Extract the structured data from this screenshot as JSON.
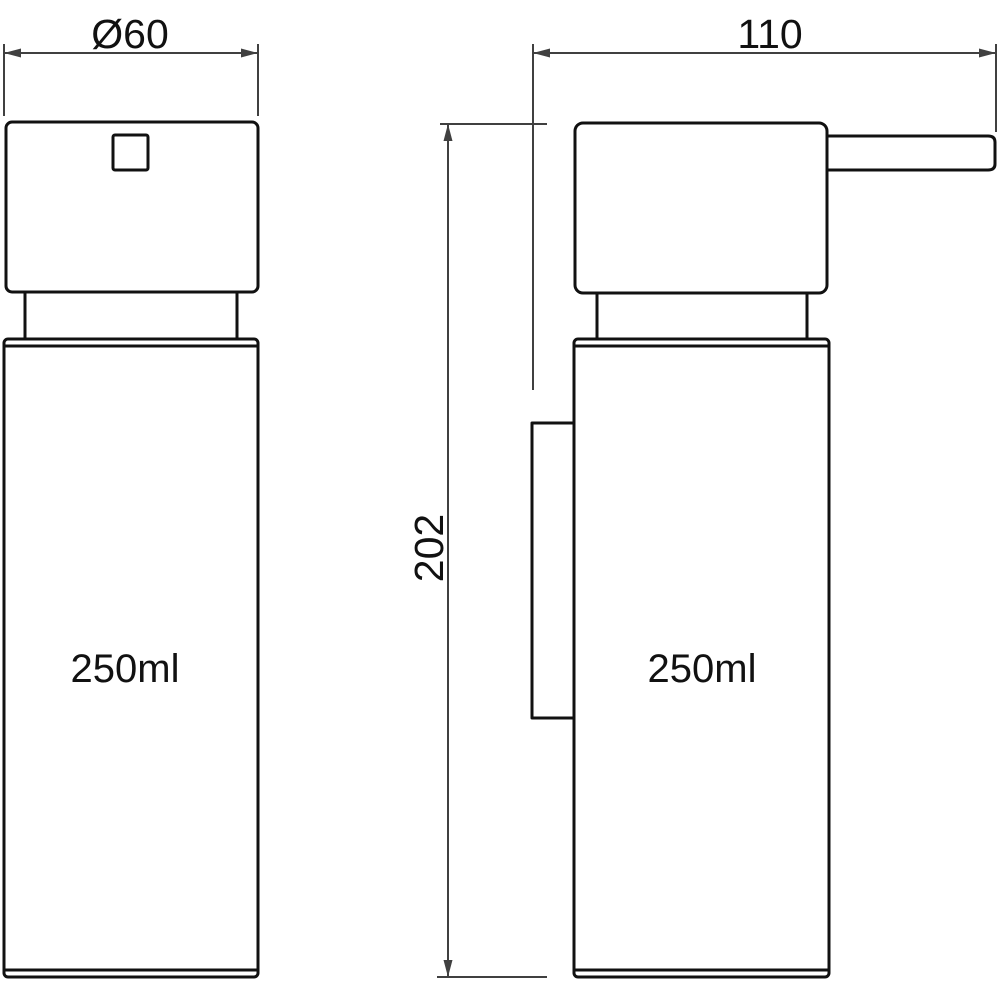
{
  "drawing": {
    "front_view": {
      "diameter_label": "Ø60",
      "volume_label": "250ml"
    },
    "side_view": {
      "width_label": "110",
      "height_label": "202",
      "volume_label": "250ml"
    }
  },
  "colors": {
    "outline": "#111111",
    "dimension": "#404040",
    "background": "#ffffff"
  }
}
